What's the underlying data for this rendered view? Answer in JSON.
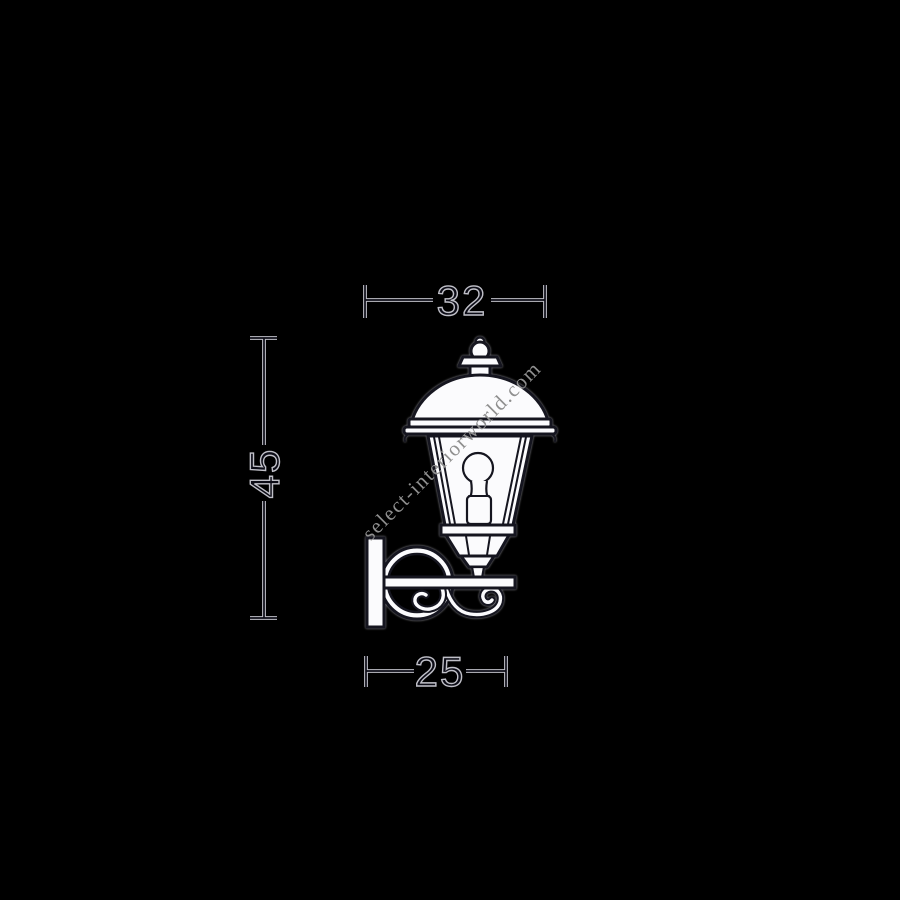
{
  "diagram": {
    "subject": "wall-mounted-lantern-line-drawing",
    "dimensions": {
      "top": {
        "label": "32"
      },
      "left": {
        "label": "45"
      },
      "bottom": {
        "label": "25"
      }
    },
    "watermark": {
      "text": "select-interiorworld.com"
    }
  },
  "colors": {
    "background": "#000000",
    "stroke_dark": "#15151f",
    "stroke_light": "#c0c0c8",
    "drawing_fill": "#fbfbfd",
    "watermark_gray": "#8f8f8f"
  }
}
